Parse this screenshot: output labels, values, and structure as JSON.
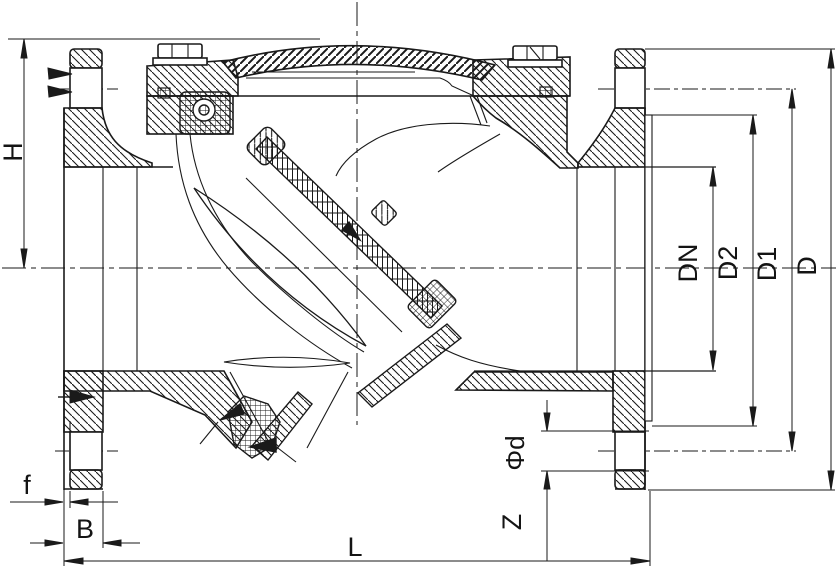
{
  "drawing": {
    "subject": "Swing check valve sectional drawing",
    "colors": {
      "line": "#1a1a1a",
      "background": "#ffffff"
    },
    "dimensions": {
      "H": "H",
      "f": "f",
      "B": "B",
      "L": "L",
      "Z": "Z",
      "phi_d": "Φd",
      "DN": "DN",
      "D2": "D2",
      "D1": "D1",
      "D": "D"
    }
  }
}
